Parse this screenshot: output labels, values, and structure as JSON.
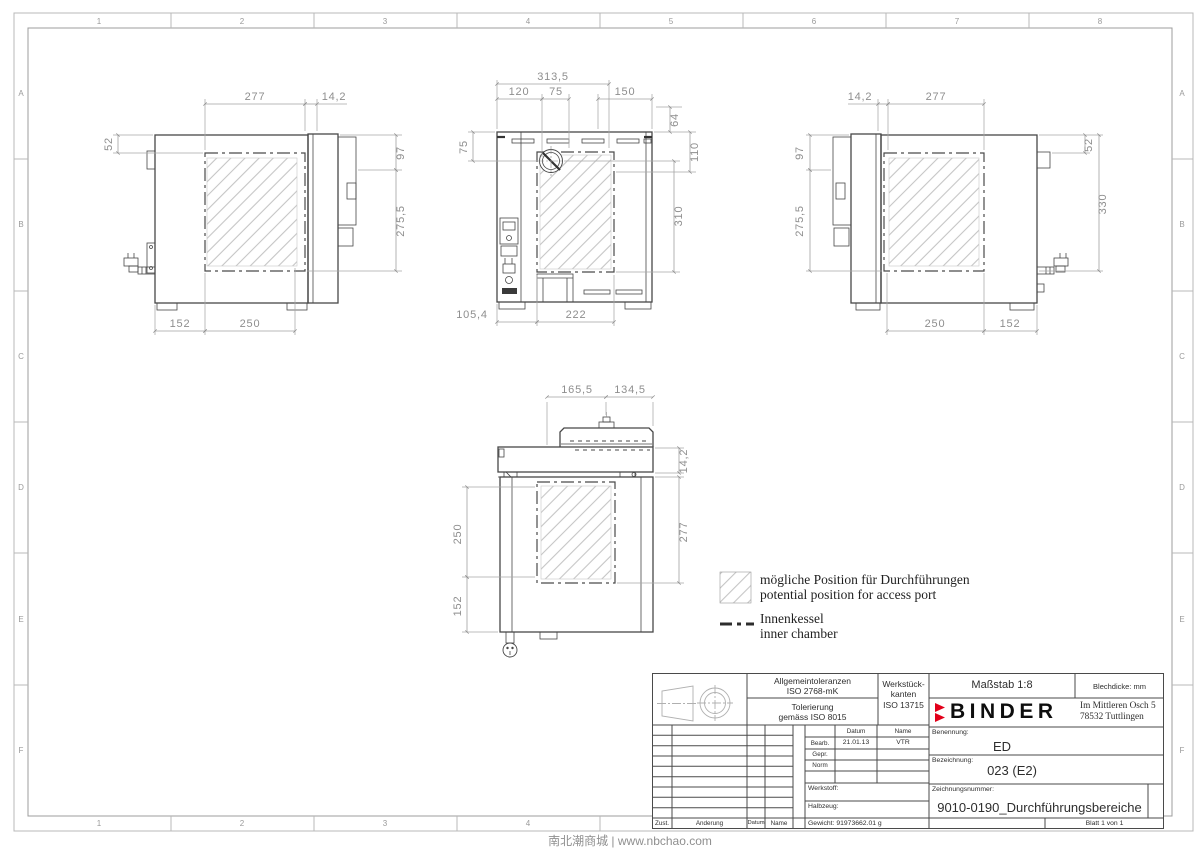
{
  "frame": {
    "cols": [
      "1",
      "2",
      "3",
      "4",
      "5",
      "6",
      "7",
      "8"
    ],
    "rows": [
      "A",
      "B",
      "C",
      "D",
      "E",
      "F"
    ]
  },
  "watermark": "南北潮商城 | www.nbchao.com",
  "legend": {
    "access_de": "mögliche Position für Durchführungen",
    "access_en": "potential position for access port",
    "chamber_de": "Innenkessel",
    "chamber_en": "inner chamber"
  },
  "views": {
    "left_side": {
      "dims": {
        "chamber_width": "277",
        "door_gap": "14,2",
        "top_inset": "52",
        "panel_height": "97",
        "chamber_height": "275,5",
        "bottom_left": "152",
        "bottom_right": "250"
      }
    },
    "rear": {
      "dims": {
        "overall": "313,5",
        "port_offset_x": "120",
        "port_pitch": "75",
        "right_span": "150",
        "stack_height": "64",
        "port_depth": "110",
        "chamber_height": "310",
        "port_offset_y": "75",
        "bottom_left": "105,4",
        "chamber_width": "222"
      }
    },
    "right_side": {
      "dims": {
        "door_gap": "14,2",
        "chamber_width": "277",
        "panel_height": "97",
        "chamber_height": "275,5",
        "top_inset": "52",
        "overall_height": "330",
        "bottom_left": "250",
        "bottom_right": "152"
      }
    },
    "top": {
      "dims": {
        "front_left": "165,5",
        "front_right": "134,5",
        "panel_depth": "14,2",
        "chamber_depth": "277",
        "chamber_span": "250",
        "rear_inset": "152"
      }
    }
  },
  "titleblock": {
    "tolerance_line1": "Allgemeintoleranzen",
    "tolerance_line2": "ISO 2768-mK",
    "tolerance_line3": "Tolerierung",
    "tolerance_line4": "gemäss ISO 8015",
    "edges_line1": "Werkstück-",
    "edges_line2": "kanten",
    "edges_line3": "ISO 13715",
    "scale": "Maßstab 1:8",
    "sheet_thickness": "Blechdicke:  mm",
    "brand": "BINDER",
    "address_line1": "Im Mittleren Ösch 5",
    "address_line2": "78532 Tuttlingen",
    "name_label": "Benennung:",
    "name_value": "ED",
    "designation_label": "Bezeichnung:",
    "designation_value": "023 (E2)",
    "drawing_number_label": "Zeichnungsnummer:",
    "drawing_number_value": "9010-0190_Durchführungsbereiche",
    "sheet": "Blatt 1 von 1",
    "col_datum": "Datum",
    "col_name": "Name",
    "row_bearb": "Bearb.",
    "bearb_date": "21.01.13",
    "bearb_name": "VTR",
    "row_gepr": "Gepr.",
    "row_norm": "Norm",
    "material_label": "Werkstoff:",
    "semi_label": "Halbzeug:",
    "weight": "Gewicht: 91973662.01 g",
    "rev_zust": "Zust.",
    "rev_aenderung": "Änderung",
    "rev_datum": "Datum",
    "rev_name": "Name"
  }
}
